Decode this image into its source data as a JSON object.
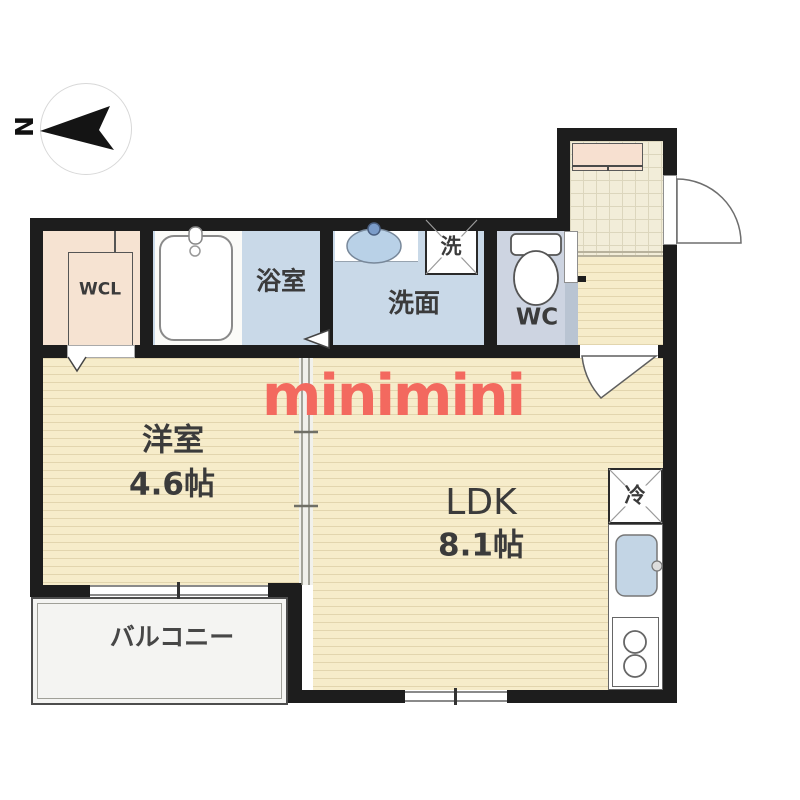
{
  "watermark": {
    "text": "minimini",
    "color": "#f3695f"
  },
  "compass": {
    "north_label": "N"
  },
  "rooms": {
    "wcl": {
      "label": "WCL"
    },
    "bathroom": {
      "label": "浴室"
    },
    "washroom": {
      "label": "洗面"
    },
    "washer": {
      "label": "洗"
    },
    "toilet": {
      "label": "WC"
    },
    "western_room": {
      "label": "洋室",
      "size": "4.6帖"
    },
    "ldk": {
      "label": "LDK",
      "size": "8.1帖"
    },
    "balcony": {
      "label": "バルコニー"
    },
    "refrigerator": {
      "label": "冷"
    }
  },
  "colors": {
    "wall": "#1d1d1d",
    "wood_floor": "#f6ecca",
    "wet_area_floor": "#c9d9e8",
    "wc_floor": "#cdd4e1",
    "closet_floor": "#f6e3d2",
    "entrance_tile": "#f2edd9",
    "balcony_floor": "#f4f4f2",
    "watermark": "#f3695f"
  }
}
